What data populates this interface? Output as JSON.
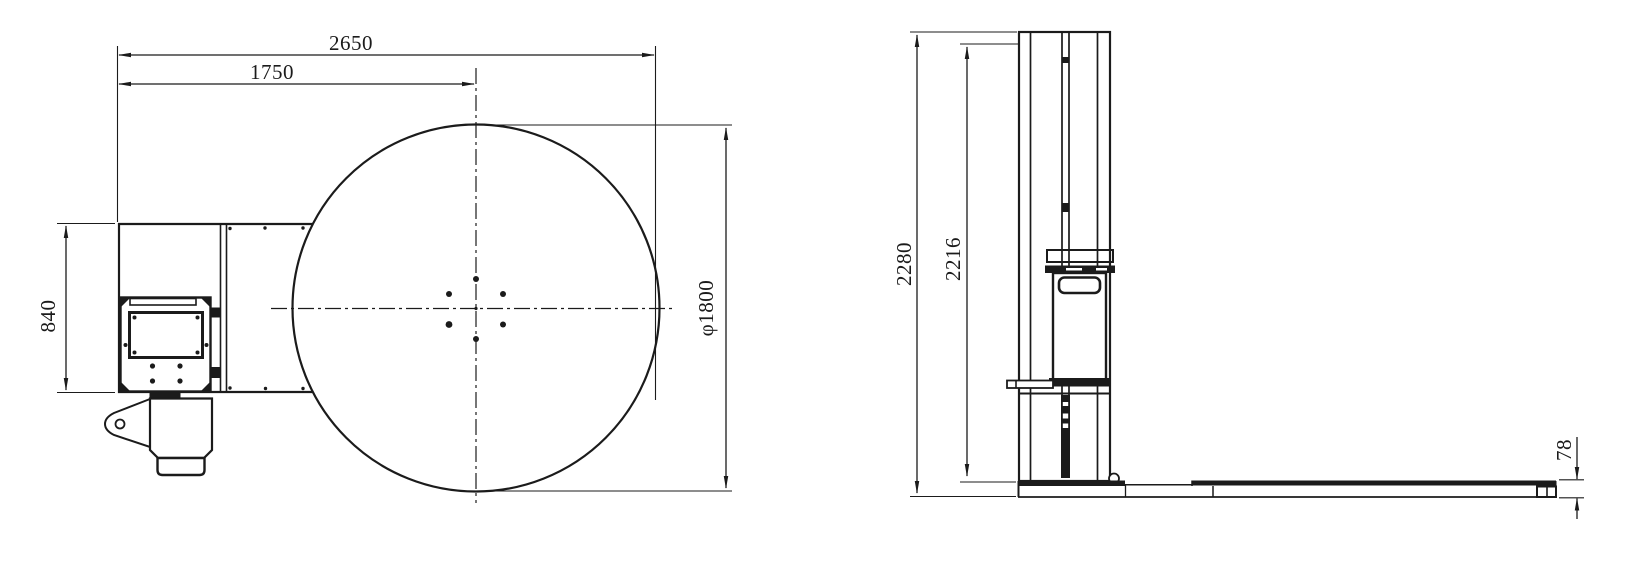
{
  "drawing": {
    "background_color": "#ffffff",
    "line_color": "#1b1b1b",
    "top_view": {
      "dim_overall_length": "2650",
      "dim_left_edge_to_turntable_center": "1750",
      "dim_body_width": "840",
      "dim_turntable_diameter": "φ1800"
    },
    "side_view": {
      "dim_overall_height": "2280",
      "dim_height_to_platform_top": "2216",
      "dim_platform_thickness": "78"
    }
  }
}
